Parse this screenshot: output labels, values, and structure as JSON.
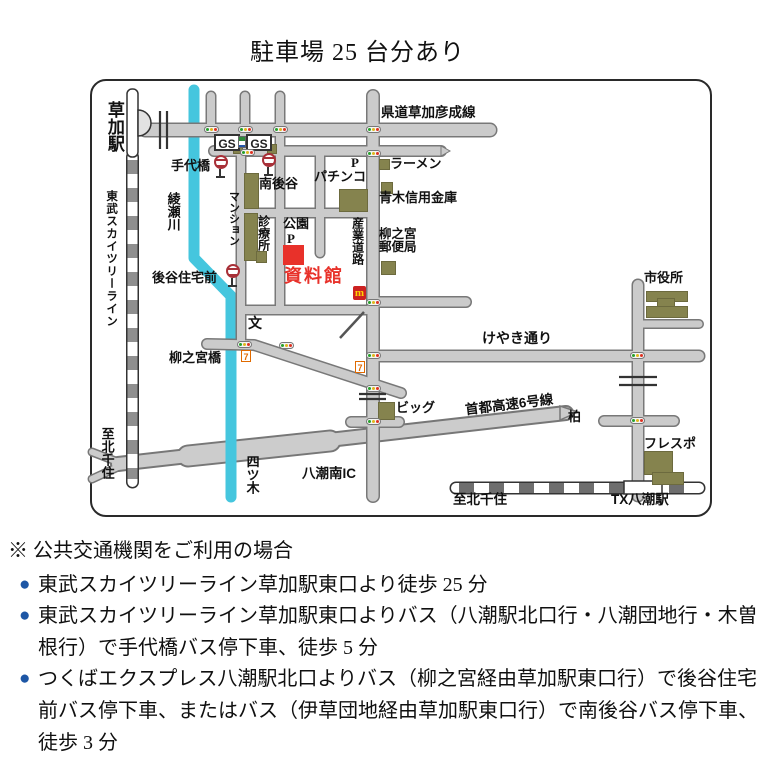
{
  "title": "駐車場 25 台分あり",
  "map": {
    "labels": {
      "soka_station": "草加駅",
      "tobu_line": "東武スカイツリーライン",
      "to_kitasenju_left": "至北千住",
      "ayase_river": "綾瀬川",
      "teshiro_bridge": "手代橋",
      "prefectural_road": "県道草加彦成線",
      "gs": "GS",
      "minami_ushiroya": "南後谷",
      "mansion": "マンション",
      "clinic": "診療所",
      "park": "公園",
      "park_p": "P",
      "pachinko": "パチンコ",
      "pachinko_p": "P",
      "museum": "資料館",
      "ramen": "ラーメン",
      "aoki_bank": "青木信用金庫",
      "post_office_line1": "柳之宮",
      "post_office_line2": "郵便局",
      "sangyo_road": "産業道路",
      "ushiroya_jutakumae": "後谷住宅前",
      "school_mark": "文",
      "yanaginomiya_bridge": "柳之宮橋",
      "keyaki_street": "けやき通り",
      "city_hall": "市役所",
      "big_store": "ビッグ",
      "shuto_expressway": "首都高速6号線",
      "kashiwa": "柏",
      "yashio_minami_ic": "八潮南IC",
      "yotsugi": "四ツ木",
      "frespo": "フレスポ",
      "tx_yashio_station": "TX八潮駅",
      "to_kitasenju_bottom": "至北千住"
    },
    "icons": {
      "mcdonalds": "m",
      "seven_eleven": "7"
    },
    "colors": {
      "museum_red": "#e8312a",
      "river_cyan": "#45c6de",
      "road_gray": "#cbcbcb",
      "building_olive": "#85834e",
      "bullet_blue": "#1d56a5",
      "mcdonalds_red": "#cc2222",
      "mcdonalds_yellow": "#ffd400",
      "seven_orange": "#e06a00"
    }
  },
  "notes": {
    "heading": "※ 公共交通機関をご利用の場合",
    "items": [
      "東武スカイツリーライン草加駅東口より徒歩 25 分",
      "東武スカイツリーライン草加駅東口よりバス（八潮駅北口行・八潮団地行・木曽根行）で手代橋バス停下車、徒歩 5 分",
      "つくばエクスプレス八潮駅北口よりバス（柳之宮経由草加駅東口行）で後谷住宅前バス停下車、またはバス（伊草団地経由草加駅東口行）で南後谷バス停下車、徒歩 3 分"
    ]
  }
}
